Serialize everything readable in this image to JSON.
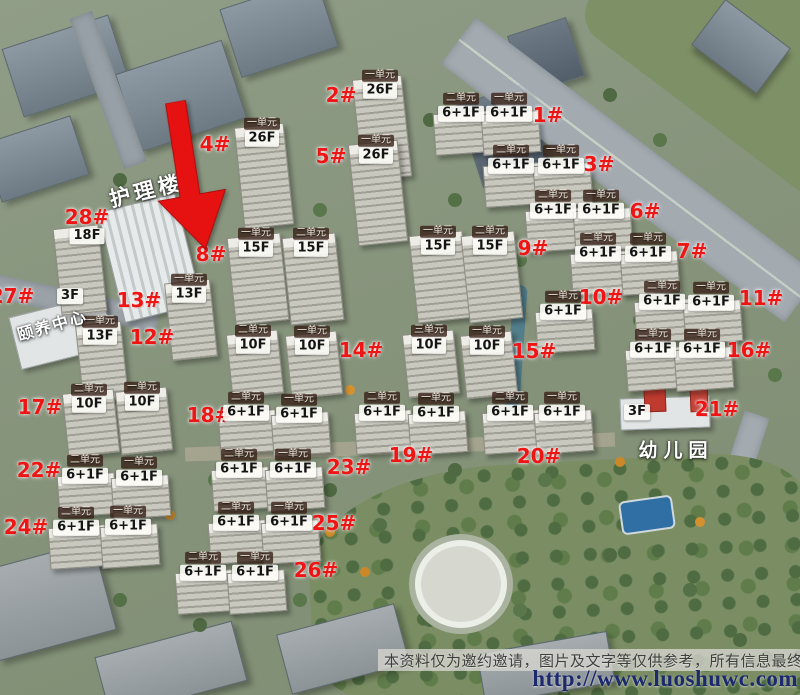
{
  "scene": {
    "disclaimer": "本资料仅为邀约邀请，图片及文字等仅供参考，所有信息最终以",
    "watermark": "http://www.luoshuwc.com"
  },
  "colors": {
    "building_number": "#ee1515",
    "unit_badge_bg": "#3a2620",
    "floor_badge_bg": "#fcfcf6",
    "arrow": "#e61212",
    "watermark_text": "#1c2a6d"
  },
  "facilities": [
    {
      "name": "护理楼"
    },
    {
      "name": "颐养中心",
      "floor_label": "3F"
    },
    {
      "name": "幼儿园",
      "floor_label": "3F"
    }
  ],
  "marker": {
    "type": "red-arrow",
    "points_to": "8#"
  },
  "buildings": [
    {
      "id": "1#",
      "units": [
        {
          "unit": "二单元",
          "floor": "6+1F"
        },
        {
          "unit": "一单元",
          "floor": "6+1F"
        }
      ]
    },
    {
      "id": "2#",
      "units": [
        {
          "unit": "一单元",
          "floor": "26F"
        }
      ]
    },
    {
      "id": "3#",
      "units": [
        {
          "unit": "二单元",
          "floor": "6+1F"
        },
        {
          "unit": "一单元",
          "floor": "6+1F"
        }
      ]
    },
    {
      "id": "4#",
      "units": [
        {
          "unit": "一单元",
          "floor": "26F"
        }
      ]
    },
    {
      "id": "5#",
      "units": [
        {
          "unit": "一单元",
          "floor": "26F"
        }
      ]
    },
    {
      "id": "6#",
      "units": [
        {
          "unit": "二单元",
          "floor": "6+1F"
        },
        {
          "unit": "一单元",
          "floor": "6+1F"
        }
      ]
    },
    {
      "id": "7#",
      "units": [
        {
          "unit": "二单元",
          "floor": "6+1F"
        },
        {
          "unit": "一单元",
          "floor": "6+1F"
        }
      ]
    },
    {
      "id": "8#",
      "units": [
        {
          "unit": "一单元",
          "floor": "15F"
        },
        {
          "unit": "二单元",
          "floor": "15F"
        }
      ]
    },
    {
      "id": "9#",
      "units": [
        {
          "unit": "一单元",
          "floor": "15F"
        },
        {
          "unit": "二单元",
          "floor": "15F"
        }
      ]
    },
    {
      "id": "10#",
      "units": [
        {
          "unit": "一单元",
          "floor": "6+1F"
        }
      ]
    },
    {
      "id": "11#",
      "units": [
        {
          "unit": "二单元",
          "floor": "6+1F"
        },
        {
          "unit": "一单元",
          "floor": "6+1F"
        }
      ]
    },
    {
      "id": "12#",
      "units": [
        {
          "unit": "一单元",
          "floor": "13F"
        }
      ]
    },
    {
      "id": "13#",
      "units": [
        {
          "unit": "一单元",
          "floor": "13F"
        }
      ]
    },
    {
      "id": "14#",
      "units": [
        {
          "unit": "二单元",
          "floor": "10F"
        },
        {
          "unit": "一单元",
          "floor": "10F"
        }
      ]
    },
    {
      "id": "15#",
      "units": [
        {
          "unit": "三单元",
          "floor": "10F"
        },
        {
          "unit": "一单元",
          "floor": "10F"
        }
      ]
    },
    {
      "id": "16#",
      "units": [
        {
          "unit": "二单元",
          "floor": "6+1F"
        },
        {
          "unit": "一单元",
          "floor": "6+1F"
        }
      ]
    },
    {
      "id": "17#",
      "units": [
        {
          "unit": "二单元",
          "floor": "10F"
        },
        {
          "unit": "一单元",
          "floor": "10F"
        }
      ]
    },
    {
      "id": "18#",
      "units": [
        {
          "unit": "二单元",
          "floor": "6+1F"
        },
        {
          "unit": "一单元",
          "floor": "6+1F"
        }
      ]
    },
    {
      "id": "19#",
      "units": [
        {
          "unit": "二单元",
          "floor": "6+1F"
        },
        {
          "unit": "一单元",
          "floor": "6+1F"
        }
      ]
    },
    {
      "id": "20#",
      "units": [
        {
          "unit": "二单元",
          "floor": "6+1F"
        },
        {
          "unit": "一单元",
          "floor": "6+1F"
        }
      ]
    },
    {
      "id": "21#",
      "units": []
    },
    {
      "id": "22#",
      "units": [
        {
          "unit": "二单元",
          "floor": "6+1F"
        },
        {
          "unit": "一单元",
          "floor": "6+1F"
        }
      ]
    },
    {
      "id": "23#",
      "units": [
        {
          "unit": "二单元",
          "floor": "6+1F"
        },
        {
          "unit": "一单元",
          "floor": "6+1F"
        }
      ]
    },
    {
      "id": "24#",
      "units": [
        {
          "unit": "二单元",
          "floor": "6+1F"
        },
        {
          "unit": "一单元",
          "floor": "6+1F"
        }
      ]
    },
    {
      "id": "25#",
      "units": [
        {
          "unit": "二单元",
          "floor": "6+1F"
        },
        {
          "unit": "一单元",
          "floor": "6+1F"
        }
      ]
    },
    {
      "id": "26#",
      "units": [
        {
          "unit": "二单元",
          "floor": "6+1F"
        },
        {
          "unit": "一单元",
          "floor": "6+1F"
        }
      ]
    },
    {
      "id": "27#",
      "units": []
    },
    {
      "id": "28#",
      "units": [],
      "floor_label": "18F"
    }
  ]
}
